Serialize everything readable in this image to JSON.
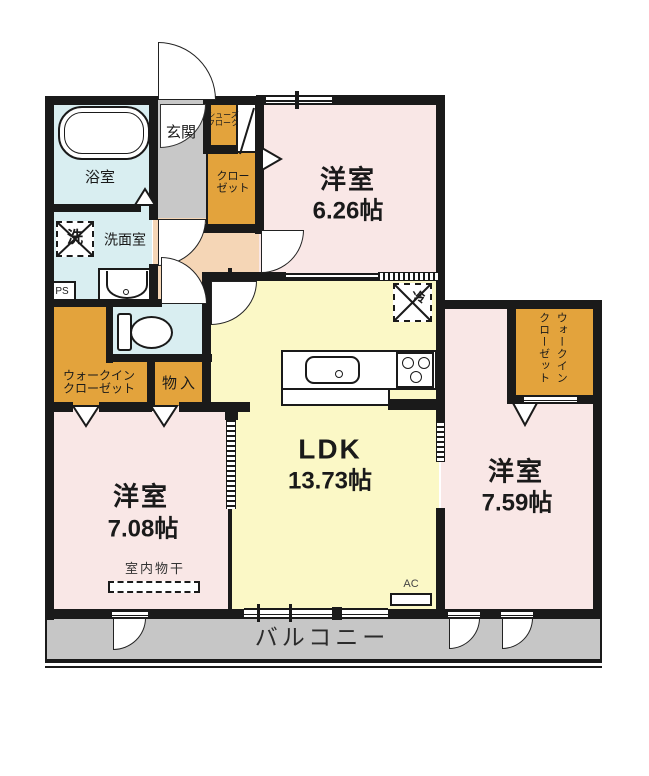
{
  "title": "apartment-floor-plan",
  "colors": {
    "wall": "#1a1a1a",
    "room_pink": "#f9e7e6",
    "ldk_yellow": "#fbf8c6",
    "wet_blue": "#d9eef1",
    "closet_orange": "#e3a33c",
    "hall_peach": "#f5d6b6",
    "genkan_gray": "#c8c8c8",
    "balcony_gray": "#c6c6c6"
  },
  "rooms": {
    "bath": {
      "label": "浴室"
    },
    "washroom": {
      "label": "洗面室",
      "washer_mark": "洗"
    },
    "pipe_space": {
      "label": "PS"
    },
    "genkan": {
      "label": "玄関"
    },
    "shoe_closet": {
      "line1": "シューズ",
      "line2": "クローク"
    },
    "closet": {
      "line1": "クロー",
      "line2": "ゼット"
    },
    "bedroom1": {
      "label": "洋室",
      "size": "6.26帖"
    },
    "ldk": {
      "label": "LDK",
      "size": "13.73帖",
      "fridge_mark": "冷",
      "ac_label": "AC"
    },
    "storage": {
      "label": "物入"
    },
    "wic_left": {
      "line1": "ウォークイン",
      "line2": "クローゼット"
    },
    "bedroom2": {
      "label": "洋室",
      "size": "7.08帖",
      "drying_label": "室内物干"
    },
    "bedroom3": {
      "label": "洋室",
      "size": "7.59帖"
    },
    "wic_right": {
      "line1": "ウォークイン",
      "line2": "クローゼット"
    },
    "balcony": {
      "label": "バルコニー"
    }
  }
}
